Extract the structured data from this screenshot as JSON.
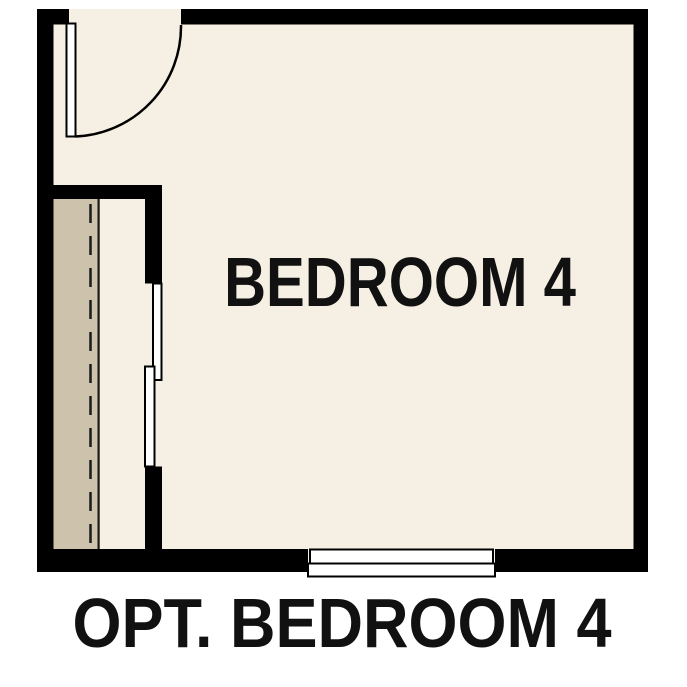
{
  "floorplan": {
    "room_label": "BEDROOM 4",
    "caption": "OPT. BEDROOM 4",
    "colors": {
      "page_bg": "#ffffff",
      "wall": "#000000",
      "floor": "#f6efe3",
      "closet_shelf": "#cdc2ab",
      "symbol_fill": "#ffffff",
      "line": "#1a1a1a",
      "text": "#111111"
    },
    "symbols": {
      "door": "hinged-door-with-swing-arc",
      "closet_doors": "bypass-sliding-doors",
      "window": "double-line-window",
      "closet_rod": "dashed-rod-line",
      "closet_shelf": "shaded-shelf-band"
    }
  }
}
